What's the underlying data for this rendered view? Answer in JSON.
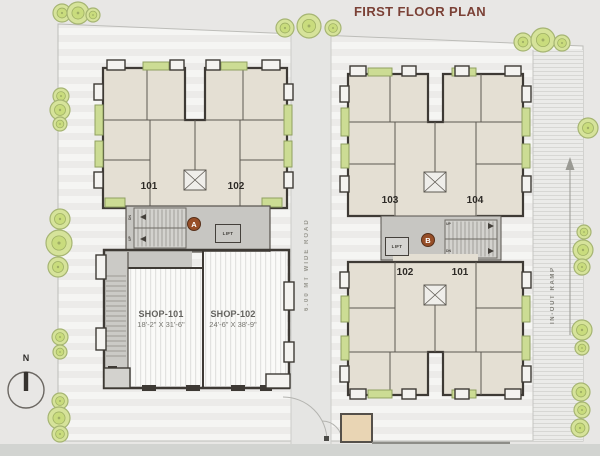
{
  "title": "FIRST FLOOR PLAN",
  "compass": {
    "label": "N"
  },
  "road": {
    "label": "6.00 MT WIDE ROAD"
  },
  "ramp": {
    "label": "IN-OUT RAMP"
  },
  "block_a": {
    "core_label": "A",
    "lift_label": "LIFT",
    "stairs": {
      "up": "UP",
      "dn": "DN"
    },
    "units": [
      {
        "number": "101"
      },
      {
        "number": "102"
      }
    ],
    "shops": [
      {
        "name": "SHOP-101",
        "size": "18'-2\" X 31'-6\""
      },
      {
        "name": "SHOP-102",
        "size": "24'-6\" X 38'-9\""
      }
    ]
  },
  "block_b": {
    "core_label": "B",
    "lift_label": "LIFT",
    "stairs": {
      "up": "UP",
      "dn": "DN"
    },
    "upper_units": [
      {
        "number": "103"
      },
      {
        "number": "104"
      }
    ],
    "lower_units": [
      {
        "number": "102"
      },
      {
        "number": "101"
      }
    ]
  },
  "colors": {
    "title": "#7b4136",
    "plate": "#e4dfd3",
    "wall": "#3e3a35",
    "green_box": "#ccdc94",
    "tree_fill": "#d6e39a",
    "core_marker": "#974e27"
  }
}
